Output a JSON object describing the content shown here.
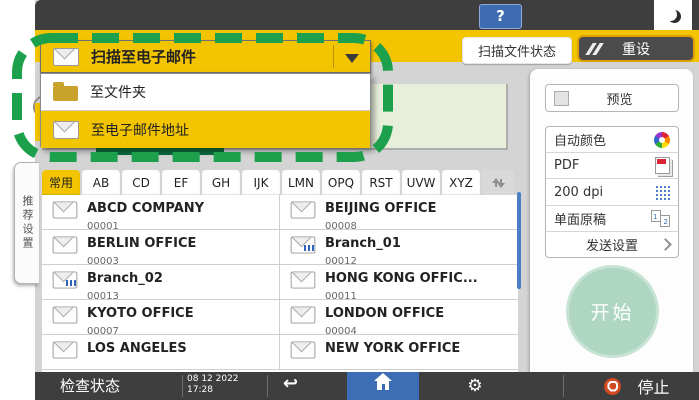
{
  "topbar": {
    "help_label": "?"
  },
  "header": {
    "scan_file_status": "扫描文件状态",
    "reset": "重设"
  },
  "scan_type_dropdown": {
    "selected": "扫描至电子邮件",
    "options": [
      {
        "label": "至文件夹"
      },
      {
        "label": "至电子邮件地址"
      }
    ]
  },
  "side_tab": {
    "label": "推荐设置"
  },
  "address_book": {
    "index_tabs": [
      "常用",
      "AB",
      "CD",
      "EF",
      "GH",
      "IJK",
      "LMN",
      "OPQ",
      "RST",
      "UVW",
      "XYZ"
    ],
    "entries": [
      {
        "name": "ABCD COMPANY",
        "number": "00001"
      },
      {
        "name": "BEIJING OFFICE",
        "number": "00008"
      },
      {
        "name": "BERLIN OFFICE",
        "number": "00003"
      },
      {
        "name": "Branch_01",
        "number": "00012"
      },
      {
        "name": "Branch_02",
        "number": "00013"
      },
      {
        "name": "HONG KONG OFFIC...",
        "number": "00011"
      },
      {
        "name": "KYOTO OFFICE",
        "number": "00007"
      },
      {
        "name": "LONDON OFFICE",
        "number": "00004"
      },
      {
        "name": "LOS ANGELES",
        "number": ""
      },
      {
        "name": "NEW YORK OFFICE",
        "number": ""
      }
    ]
  },
  "right_panel": {
    "preview": "预览",
    "settings": [
      {
        "label": "自动颜色",
        "icon": "auto-color-icon"
      },
      {
        "label": "PDF",
        "icon": "pdf-file-icon"
      },
      {
        "label": "200 dpi",
        "icon": "resolution-icon"
      },
      {
        "label": "单面原稿",
        "icon": "one-sided-original-icon"
      }
    ],
    "send_settings": "发送设置",
    "start": "开始"
  },
  "bottom_bar": {
    "check_status": "检查状态",
    "date": "08 12 2022",
    "time": "17:28",
    "stop": "停止"
  },
  "icon_glyphs": {
    "back_arrow": "↩",
    "gear": "⚙",
    "page1": "1",
    "page2": "2"
  },
  "colors": {
    "accent_yellow": "#f2c500",
    "bar_dark": "#3e3e3e",
    "home_blue": "#3d6db5",
    "annotation_green": "#1ca04c",
    "start_green": "#aed6c2",
    "stop_red": "#d14a21",
    "dest_box_green": "#e7efdb"
  }
}
